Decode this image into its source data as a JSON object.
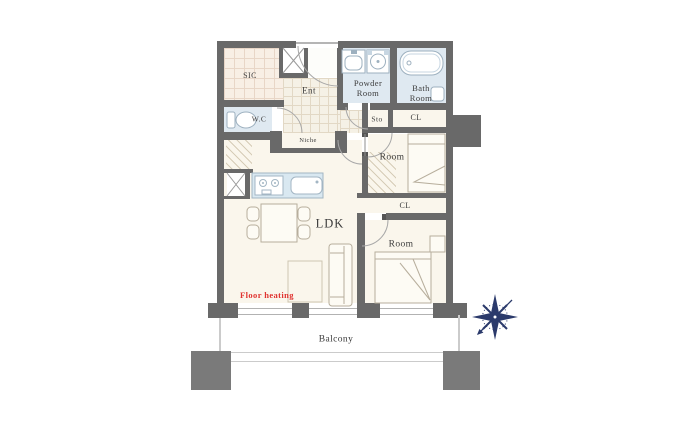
{
  "document_type": "apartment-floor-plan",
  "palette": {
    "wall": "#696969",
    "floor_cream": "#faf6ec",
    "wet_room_blue": "#dfe9f1",
    "entrance_tile": "#f5f1e6",
    "sic_tile": "#f8efe5",
    "kitchen_counter_blue": "#d9e8f1",
    "balcony_pillar_gray": "#7a7a7a",
    "compass_navy": "#2b3a6b",
    "floor_heating_red": "#e03330",
    "label_text": "#3c3c3c"
  },
  "labels": {
    "sic": "SIC",
    "ent": "Ent",
    "powder_room": "Powder\nRoom",
    "bath_room": "Bath\nRoom",
    "wc": "W.C",
    "sto": "Sto",
    "closet_top": "CL",
    "niche": "Niche",
    "room_upper": "Room",
    "closet_mid": "CL",
    "room_lower": "Room",
    "ldk": "LDK",
    "floor_heating": "Floor heating",
    "balcony": "Balcony"
  },
  "icons": {
    "compass_rose": "8-point-star-with-southwest-arrow",
    "bathtub": "rounded-rect-tub",
    "toilet": "tank-and-bowl",
    "washbasin": "square-basin",
    "washer_pan": "square-with-circle-drain",
    "stove": "two-burner-cooktop",
    "kitchen_sink": "rounded-rect-sink",
    "pipe_shaft": "box-with-x-cross",
    "dining_table": "table-with-four-chairs",
    "sofa": "two-seat-sofa",
    "bed": "bed-with-folded-blanket",
    "rug": "square-rug",
    "door_swing": "quarter-circle-arc"
  },
  "rooms_visible": [
    "SIC",
    "Ent",
    "Powder Room",
    "Bath Room",
    "W.C",
    "Sto",
    "CL",
    "Niche",
    "Room",
    "CL",
    "Room",
    "LDK",
    "Balcony"
  ]
}
